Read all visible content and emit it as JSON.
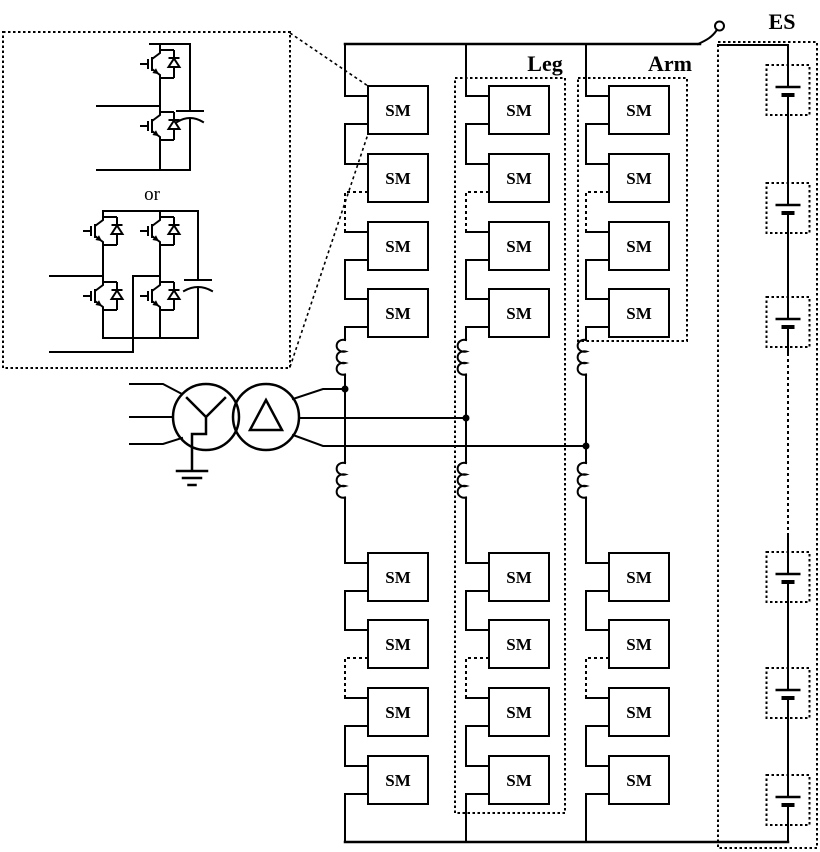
{
  "labels": {
    "sm": "SM",
    "leg": "Leg",
    "arm": "Arm",
    "es": "ES",
    "or": "or"
  },
  "colors": {
    "stroke": "#000000",
    "background": "#ffffff"
  },
  "icons": {
    "half_bridge": "half-bridge-submodule-circuit-icon",
    "full_bridge": "full-bridge-submodule-circuit-icon",
    "igbt": "igbt-with-antiparallel-diode-icon",
    "capacitor": "capacitor-icon",
    "transformer": "wye-delta-transformer-icon",
    "ground": "earth-ground-icon",
    "inductor": "arm-inductor-coil-icon",
    "battery": "battery-cell-icon",
    "tap_hook": "dc-bus-tap-hook-icon"
  }
}
